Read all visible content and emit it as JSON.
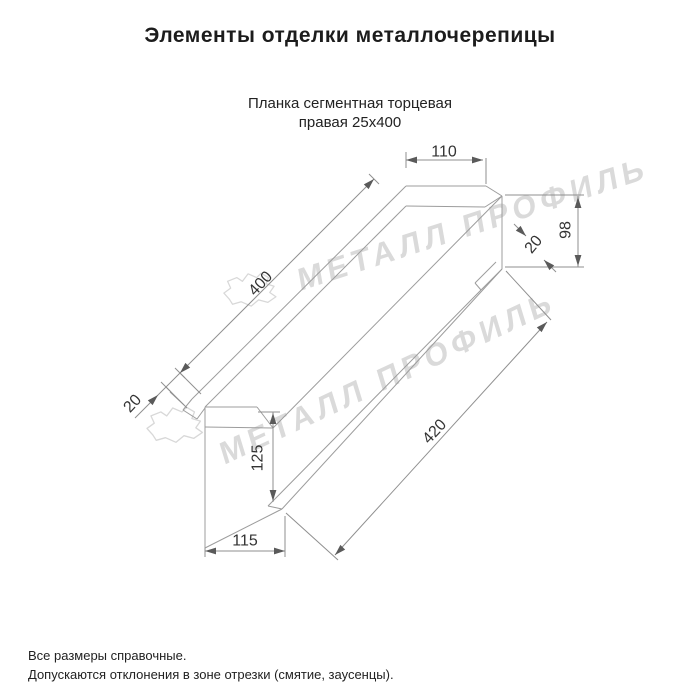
{
  "header": {
    "title": "Элементы отделки металлочерепицы",
    "subtitle_line1": "Планка сегментная торцевая",
    "subtitle_line2": "правая 25х400"
  },
  "footer": {
    "line1": "Все размеры справочные.",
    "line2": "Допускаются отклонения в зоне отрезки (смятие, заусенцы)."
  },
  "watermark": {
    "text": "МЕТАЛЛ ПРОФИЛЬ",
    "color": "#dadada",
    "instances": [
      {
        "x": 300,
        "y": 291,
        "rotate": -18,
        "cloud_x": 222,
        "cloud_y": 272,
        "cloud_scale": 0.62
      },
      {
        "x": 224,
        "y": 465,
        "rotate": -25,
        "cloud_x": 145,
        "cloud_y": 406,
        "cloud_scale": 0.66
      }
    ],
    "cloud_path": "M12,44 L3,34 L14,26 L9,15 L24,9 L33,15 L42,3 L56,9 L63,2 L75,9 L71,19 L84,23 L77,33 L87,40 L74,49 L59,45 L47,55 L31,48 L17,52 Z"
  },
  "drawing": {
    "part_color": "#9c9c9c",
    "dim_color": "#8f8f8f",
    "text_color": "#333333",
    "part_lines": [
      [
        406,
        186,
        486,
        186
      ],
      [
        406,
        206,
        485,
        207
      ],
      [
        486,
        186,
        502,
        196
      ],
      [
        485,
        207,
        502,
        196
      ],
      [
        502,
        196,
        502,
        269
      ],
      [
        502,
        269,
        481,
        290
      ],
      [
        496,
        262,
        475,
        283
      ],
      [
        475,
        283,
        481,
        290
      ],
      [
        406,
        186,
        192,
        399
      ],
      [
        406,
        206,
        205,
        407
      ],
      [
        502,
        196,
        273,
        428
      ],
      [
        502,
        269,
        282,
        509
      ],
      [
        481,
        290,
        268,
        506
      ],
      [
        205,
        407,
        205,
        548
      ],
      [
        205,
        407,
        257,
        407
      ],
      [
        257,
        407,
        273,
        428
      ],
      [
        205,
        427,
        273,
        428
      ],
      [
        192,
        399,
        183,
        410
      ],
      [
        183,
        410,
        197,
        419
      ],
      [
        197,
        419,
        205,
        408
      ],
      [
        170,
        392,
        184,
        405
      ],
      [
        268,
        506,
        282,
        509
      ],
      [
        205,
        548,
        282,
        509
      ]
    ],
    "dim_lines": [
      [
        406,
        160,
        483,
        160
      ],
      [
        406,
        152,
        406,
        168
      ],
      [
        486,
        158,
        486,
        184
      ],
      [
        578,
        196,
        578,
        267
      ],
      [
        505,
        195,
        584,
        195
      ],
      [
        505,
        267,
        584,
        267
      ],
      [
        374,
        179,
        135,
        418
      ],
      [
        369,
        174,
        379,
        184
      ],
      [
        175,
        368,
        185,
        378
      ],
      [
        161,
        382,
        171,
        392
      ],
      [
        180,
        373,
        201,
        394
      ],
      [
        166,
        387,
        187,
        408
      ],
      [
        547,
        322,
        335,
        555
      ],
      [
        506,
        271,
        551,
        320
      ],
      [
        286,
        513,
        338,
        560
      ],
      [
        514,
        224,
        526,
        236
      ],
      [
        544,
        260,
        556,
        272
      ],
      [
        273,
        412,
        273,
        502
      ],
      [
        258,
        412,
        280,
        412
      ],
      [
        205,
        551,
        285,
        551
      ],
      [
        285,
        516,
        285,
        557
      ],
      [
        205,
        548,
        205,
        557
      ]
    ],
    "arrows": [
      [
        406,
        160,
        180
      ],
      [
        483,
        160,
        0
      ],
      [
        578,
        197,
        -90
      ],
      [
        578,
        266,
        90
      ],
      [
        374,
        179,
        -45
      ],
      [
        180,
        373,
        135
      ],
      [
        158,
        395,
        -45
      ],
      [
        547,
        322,
        -45
      ],
      [
        335,
        555,
        135
      ],
      [
        526,
        236,
        45
      ],
      [
        544,
        260,
        -135
      ],
      [
        273,
        413,
        -90
      ],
      [
        273,
        501,
        90
      ],
      [
        205,
        551,
        180
      ],
      [
        285,
        551,
        0
      ]
    ],
    "labels": [
      {
        "text": "110",
        "x": 444,
        "y": 151,
        "rotate": 0
      },
      {
        "text": "98",
        "x": 565,
        "y": 230,
        "rotate": -90
      },
      {
        "text": "20",
        "x": 533,
        "y": 244,
        "rotate": -50
      },
      {
        "text": "400",
        "x": 260,
        "y": 283,
        "rotate": -47
      },
      {
        "text": "420",
        "x": 434,
        "y": 431,
        "rotate": -47
      },
      {
        "text": "20",
        "x": 132,
        "y": 403,
        "rotate": -47
      },
      {
        "text": "125",
        "x": 257,
        "y": 458,
        "rotate": -90
      },
      {
        "text": "115",
        "x": 245,
        "y": 540,
        "rotate": 0
      }
    ]
  }
}
